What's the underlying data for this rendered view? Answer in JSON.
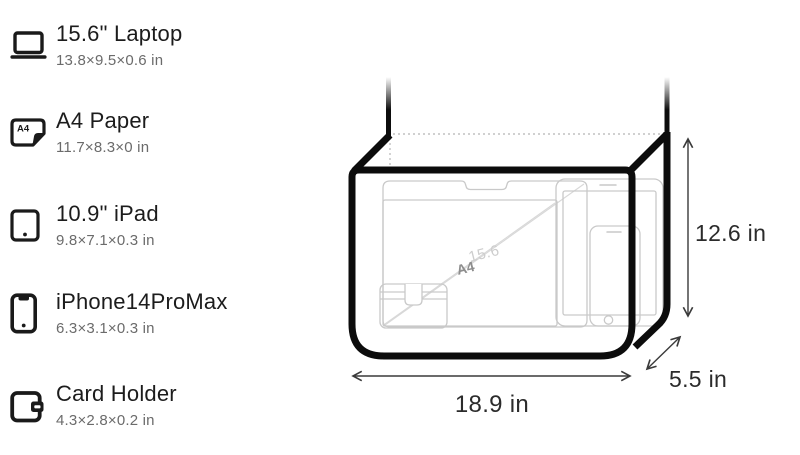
{
  "legend": {
    "items": [
      {
        "title": "15.6\" Laptop",
        "dims": "13.8×9.5×0.6 in",
        "icon": "laptop-icon"
      },
      {
        "title": "A4 Paper",
        "dims": "11.7×8.3×0 in",
        "icon": "a4-paper-icon"
      },
      {
        "title": "10.9\" iPad",
        "dims": "9.8×7.1×0.3 in",
        "icon": "ipad-icon"
      },
      {
        "title": "iPhone14ProMax",
        "dims": "6.3×3.1×0.3 in",
        "icon": "iphone-icon"
      },
      {
        "title": "Card Holder",
        "dims": "4.3×2.8×0.2 in",
        "icon": "card-holder-icon"
      }
    ],
    "a4_icon_text": "A4"
  },
  "diagram": {
    "width_label": "18.9 in",
    "height_label": "12.6 in",
    "depth_label": "5.5 in",
    "inner_labels": {
      "laptop": "15.6",
      "a4": "A4"
    },
    "colors": {
      "bag_outline": "#0c0c0c",
      "item_outline": "#c9c9c9",
      "diagonal_line": "#d8d8d8",
      "dotted_hidden_edge": "#c0c0c0",
      "dimension_line": "#3a3a3a",
      "dimension_text": "#2b2b2b",
      "inner_label_a4": "#8d8d8d",
      "inner_label_laptop": "#cdcdcd",
      "legend_title": "#1c1c1c",
      "legend_dims": "#6b6b6b"
    }
  }
}
